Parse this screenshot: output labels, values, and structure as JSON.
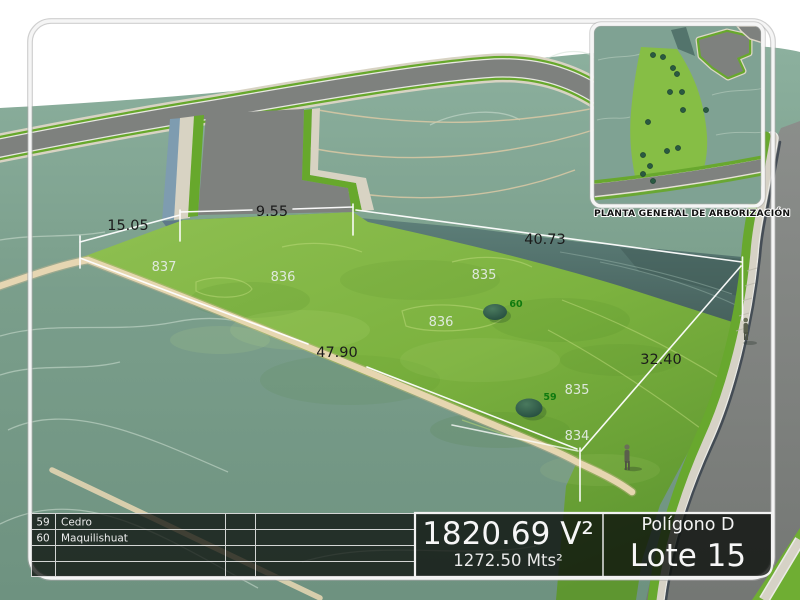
{
  "dimensions": [
    {
      "label": "15.05"
    },
    {
      "label": "9.55"
    },
    {
      "label": "40.73"
    },
    {
      "label": "47.90"
    },
    {
      "label": "32.40"
    }
  ],
  "contour_labels": [
    {
      "label": "837"
    },
    {
      "label": "836"
    },
    {
      "label": "835"
    },
    {
      "label": "836"
    },
    {
      "label": "835"
    },
    {
      "label": "834"
    }
  ],
  "tree_markers": [
    {
      "code": "60"
    },
    {
      "code": "59"
    }
  ],
  "inset": {
    "caption": "PLANTA GENERAL DE ARBORIZACIÓN"
  },
  "legend": {
    "rows": [
      {
        "code": "59",
        "species": "Cedro"
      },
      {
        "code": "60",
        "species": "Maquilishuat"
      }
    ]
  },
  "title_block": {
    "area_varas": "1820.69 V²",
    "area_meters": "1272.50 Mts²",
    "polygon_name": "Polígono D",
    "lot_name": "Lote 15"
  },
  "colors": {
    "terrain": "#7a9b88",
    "grass": "#7cae41",
    "slope": "#53716c",
    "road": "#7e817e",
    "dirt_path": "#ead8b4",
    "frame": "#f5f5f5",
    "tree_label": "#0f7a0f"
  }
}
